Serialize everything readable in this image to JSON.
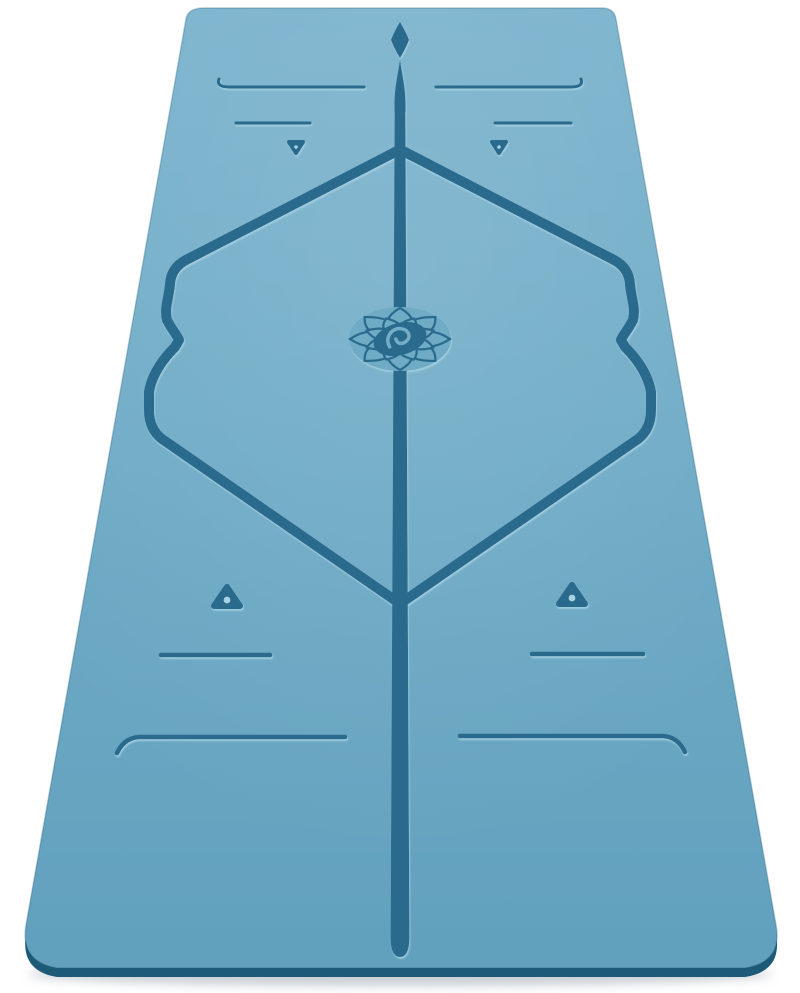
{
  "image": {
    "alt": "Blue yoga mat photographed upright in perspective on a white background, with etched alignment markings and a lotus flower logo in the centre",
    "subject": "yoga-mat",
    "background": "plain white"
  },
  "colors": {
    "background": "#ffffff",
    "mat_top": "#7bb3cd",
    "mat_mid": "#6fabc6",
    "mat_bottom": "#61a0bd",
    "line": "#2c6a8c",
    "emboss": "#a7d2e3",
    "mat_edge": "#1d5a78",
    "shadow": "#c9cfd3",
    "logo_swirl": "#74adc8"
  },
  "markings": {
    "center_line": "vertical-center-alignment-line-with-diamond-tip",
    "frame": "central-alignment-frame-with-wavy-sides",
    "logo": "lotus-flower-logo-with-oval-swirl-badge",
    "end_lines": "horizontal-end-lines-with-curled-outer-tips",
    "mid_lines": "short-horizontal-placement-lines",
    "markers_top": "two-small-down-pointing-triangle-markers",
    "markers_bottom": "two-up-pointing-triangle-markers-with-center-dots"
  }
}
